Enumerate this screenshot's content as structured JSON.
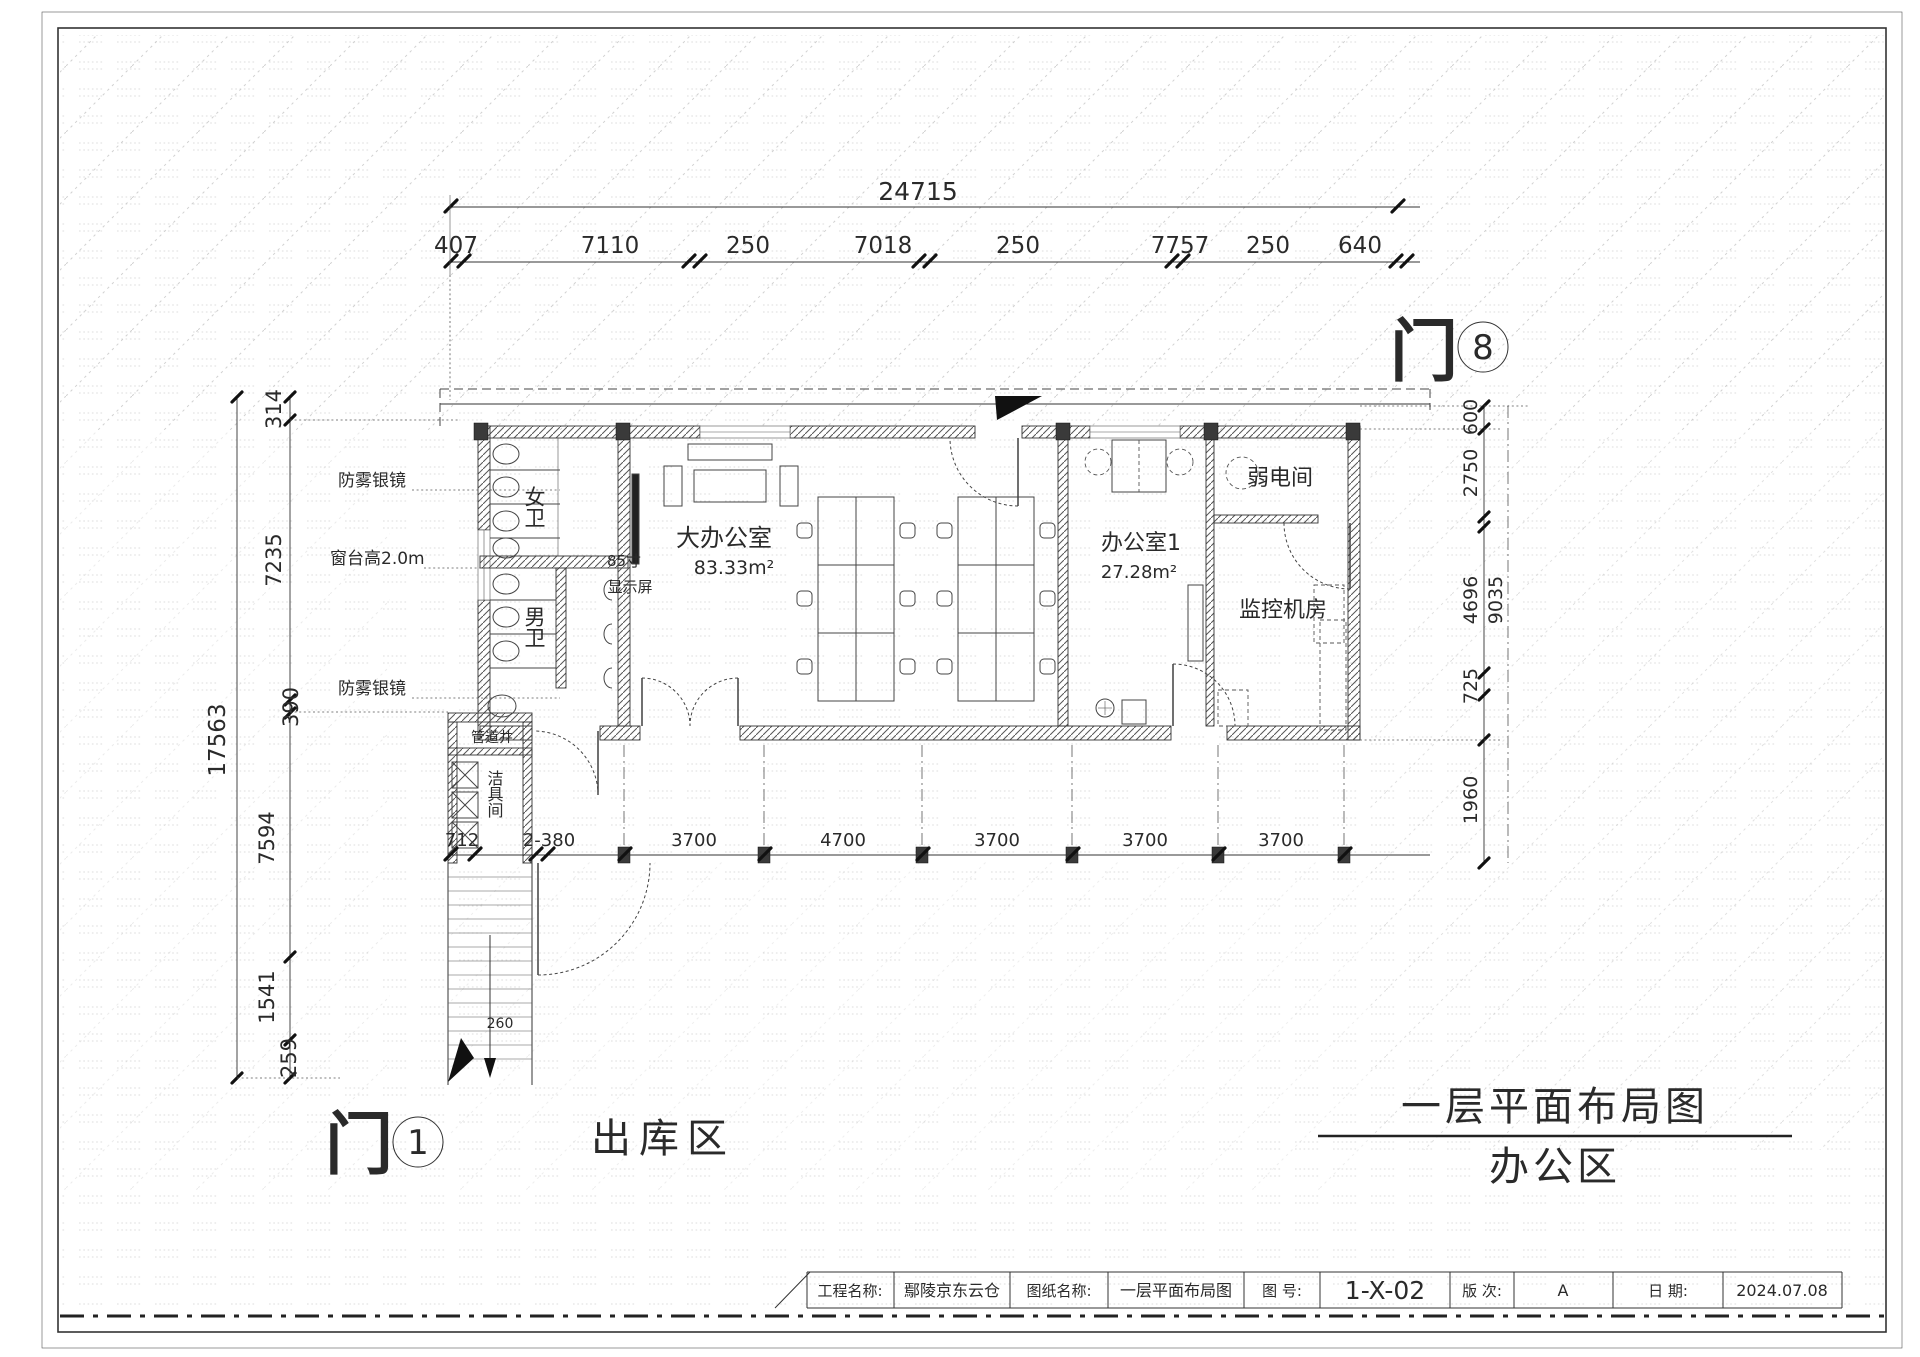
{
  "sheet": {
    "main_title": {
      "line1": "一层平面布局图",
      "line2": "办公区"
    },
    "outbound_label": "出库区",
    "door1": {
      "char": "门",
      "num": "1"
    },
    "door8": {
      "char": "门",
      "num": "8"
    },
    "title_block": {
      "project_label": "工程名称:",
      "project_value": "鄢陵京东云仓",
      "drawing_label": "图纸名称:",
      "drawing_value": "一层平面布局图",
      "number_label": "图  号:",
      "number_value": "1-X-02",
      "revision_label": "版  次:",
      "revision_value": "A",
      "date_label": "日  期:",
      "date_value": "2024.07.08"
    }
  },
  "rooms": {
    "big_office": {
      "name": "大办公室",
      "area": "83.33m²"
    },
    "office1": {
      "name": "办公室1",
      "area": "27.28m²"
    },
    "weak_current": "弱电间",
    "monitor_room": "监控机房",
    "women_wc": "女卫",
    "men_wc": "男卫",
    "cleaning_room": "洁具间",
    "pipe_shaft": "管道井"
  },
  "annotations": {
    "mirror_top": "防雾银镜",
    "sill": "窗台高2.0m",
    "mirror_bottom": "防雾银镜",
    "display_line1": "85寸",
    "display_line2": "显示屏",
    "stair_note": "260"
  },
  "dims": {
    "top_total": "24715",
    "top_segments": [
      "407",
      "7110",
      "250",
      "7018",
      "250",
      "7757",
      "250",
      "640"
    ],
    "left_total": "17563",
    "left_segments": [
      "314",
      "7235",
      "390",
      "7594",
      "1541",
      "259"
    ],
    "right_outer": "9035",
    "right_segments": [
      "600",
      "2750",
      "4696",
      "725",
      "1960"
    ],
    "bottom_segments": [
      "712",
      "2-380",
      "3700",
      "4700",
      "3700",
      "3700",
      "3700"
    ]
  }
}
